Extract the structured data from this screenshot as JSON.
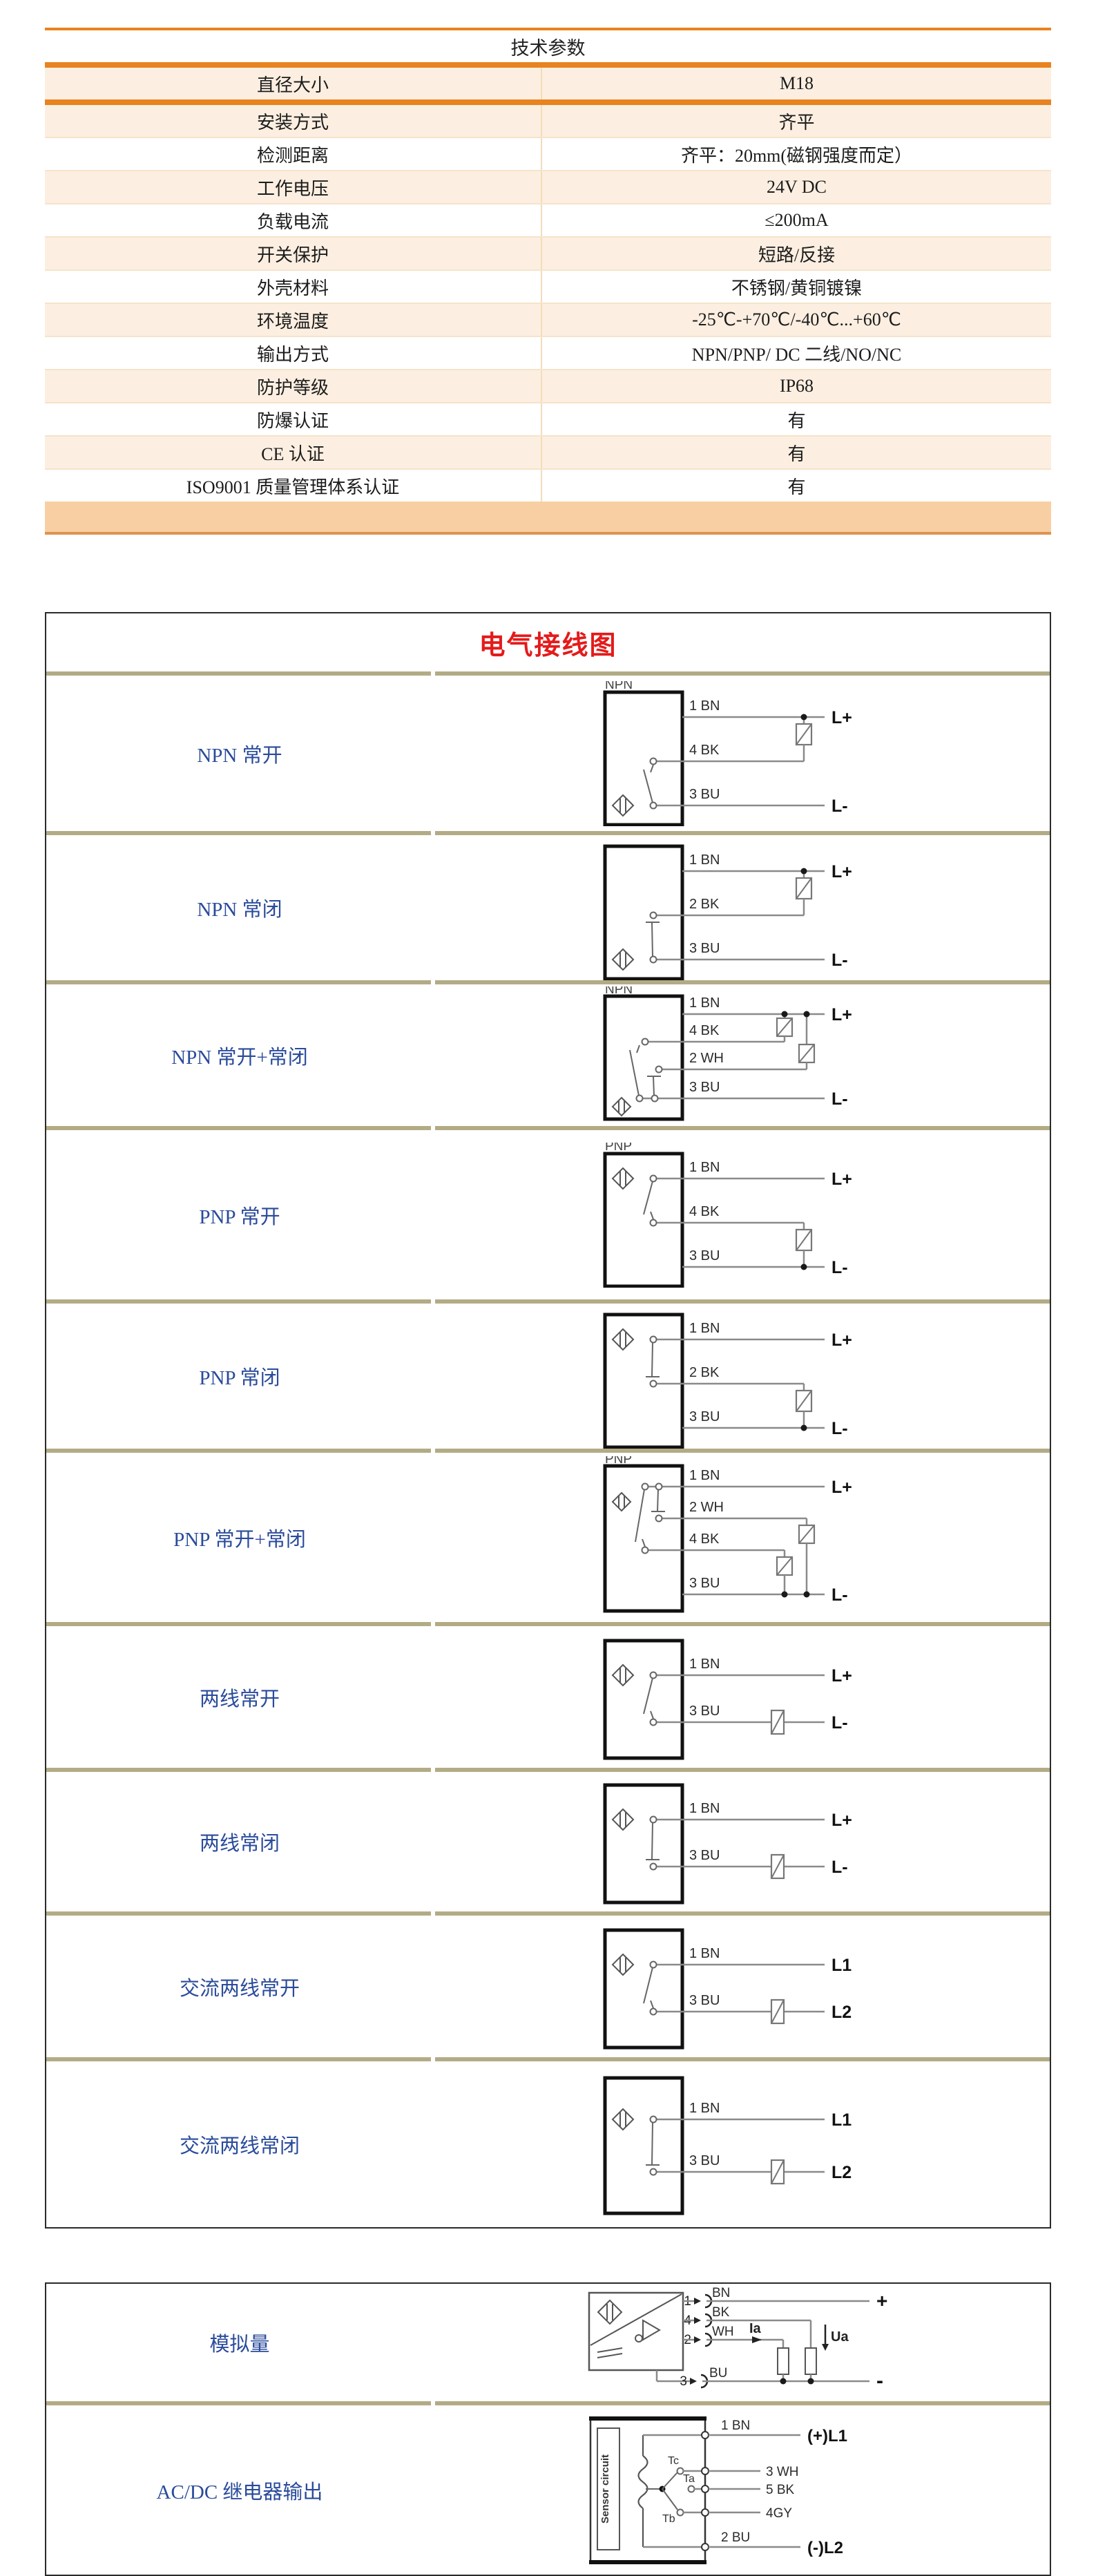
{
  "spec_table": {
    "title": "技术参数",
    "rows": [
      {
        "label": "直径大小",
        "value": "M18"
      },
      {
        "label": "安装方式",
        "value": "齐平"
      },
      {
        "label": "检测距离",
        "value": "齐平：20mm(磁钢强度而定）"
      },
      {
        "label": "工作电压",
        "value": "24V DC"
      },
      {
        "label": "负载电流",
        "value": "≤200mA"
      },
      {
        "label": "开关保护",
        "value": "短路/反接"
      },
      {
        "label": "外壳材料",
        "value": "不锈钢/黄铜镀镍"
      },
      {
        "label": "环境温度",
        "value": "-25℃-+70℃/-40℃...+60℃"
      },
      {
        "label": "输出方式",
        "value": "NPN/PNP/ DC 二线/NO/NC"
      },
      {
        "label": "防护等级",
        "value": "IP68"
      },
      {
        "label": "防爆认证",
        "value": "有"
      },
      {
        "label": "CE 认证",
        "value": "有"
      },
      {
        "label": "ISO9001 质量管理体系认证",
        "value": "有"
      }
    ],
    "accent_color": "#E8831F",
    "row_color": "#FCEFE1"
  },
  "wiring": {
    "title": "电气接线图",
    "label_color": "#2A4B9B",
    "title_color": "#E51A1A",
    "rows": [
      {
        "label": "NPN 常开",
        "type": "dc3n",
        "nc": false,
        "diagram_title": "NPN",
        "pins": [
          "1 BN",
          "4 BK",
          "3 BU"
        ],
        "terminals": [
          "L+",
          "L-"
        ]
      },
      {
        "label": "NPN 常闭",
        "type": "dc3n",
        "nc": true,
        "diagram_title": "",
        "pins": [
          "1 BN",
          "2 BK",
          "3 BU"
        ],
        "terminals": [
          "L+",
          "L-"
        ]
      },
      {
        "label": "NPN 常开+常闭",
        "type": "dc4n",
        "nc": false,
        "diagram_title": "NPN",
        "pins": [
          "1 BN",
          "4 BK",
          "2 WH",
          "3 BU"
        ],
        "terminals": [
          "L+",
          "L-"
        ]
      },
      {
        "label": "PNP 常开",
        "type": "dc3p",
        "nc": false,
        "diagram_title": "PNP",
        "pins": [
          "1 BN",
          "4 BK",
          "3 BU"
        ],
        "terminals": [
          "L+",
          "L-"
        ]
      },
      {
        "label": "PNP 常闭",
        "type": "dc3p",
        "nc": true,
        "diagram_title": "",
        "pins": [
          "1 BN",
          "2 BK",
          "3 BU"
        ],
        "terminals": [
          "L+",
          "L-"
        ]
      },
      {
        "label": "PNP 常开+常闭",
        "type": "dc4p",
        "nc": false,
        "diagram_title": "PNP",
        "pins": [
          "1 BN",
          "2 WH",
          "4 BK",
          "3 BU"
        ],
        "terminals": [
          "L+",
          "L-"
        ]
      },
      {
        "label": "两线常开",
        "type": "two",
        "nc": false,
        "diagram_title": "",
        "pins": [
          "1 BN",
          "3 BU"
        ],
        "terminals": [
          "L+",
          "L-"
        ]
      },
      {
        "label": "两线常闭",
        "type": "two",
        "nc": true,
        "diagram_title": "",
        "pins": [
          "1 BN",
          "3 BU"
        ],
        "terminals": [
          "L+",
          "L-"
        ]
      },
      {
        "label": "交流两线常开",
        "type": "two",
        "nc": false,
        "diagram_title": "",
        "pins": [
          "1 BN",
          "3 BU"
        ],
        "terminals": [
          "L1",
          "L2"
        ]
      },
      {
        "label": "交流两线常闭",
        "type": "two",
        "nc": true,
        "diagram_title": "",
        "pins": [
          "1 BN",
          "3 BU"
        ],
        "terminals": [
          "L1",
          "L2"
        ]
      }
    ]
  },
  "analog_table": {
    "rows": [
      {
        "label": "模拟量",
        "type": "analog",
        "pins": [
          {
            "n": "1",
            "c": "BN"
          },
          {
            "n": "4",
            "c": "BK"
          },
          {
            "n": "2",
            "c": "WH"
          },
          {
            "n": "3",
            "c": "BU"
          }
        ],
        "current_label": "Ia",
        "voltage_label": "Ua",
        "terminals": [
          "+",
          "-"
        ]
      },
      {
        "label": "AC/DC 继电器输出",
        "type": "relay",
        "inner_label": "Sensor circuit",
        "contacts": [
          "Tc",
          "Ta",
          "Tb"
        ],
        "pins": [
          "1 BN",
          "3 WH",
          "5 BK",
          "4GY",
          "2 BU"
        ],
        "terminals": [
          "(+)L1",
          "(-)L2"
        ]
      }
    ]
  }
}
